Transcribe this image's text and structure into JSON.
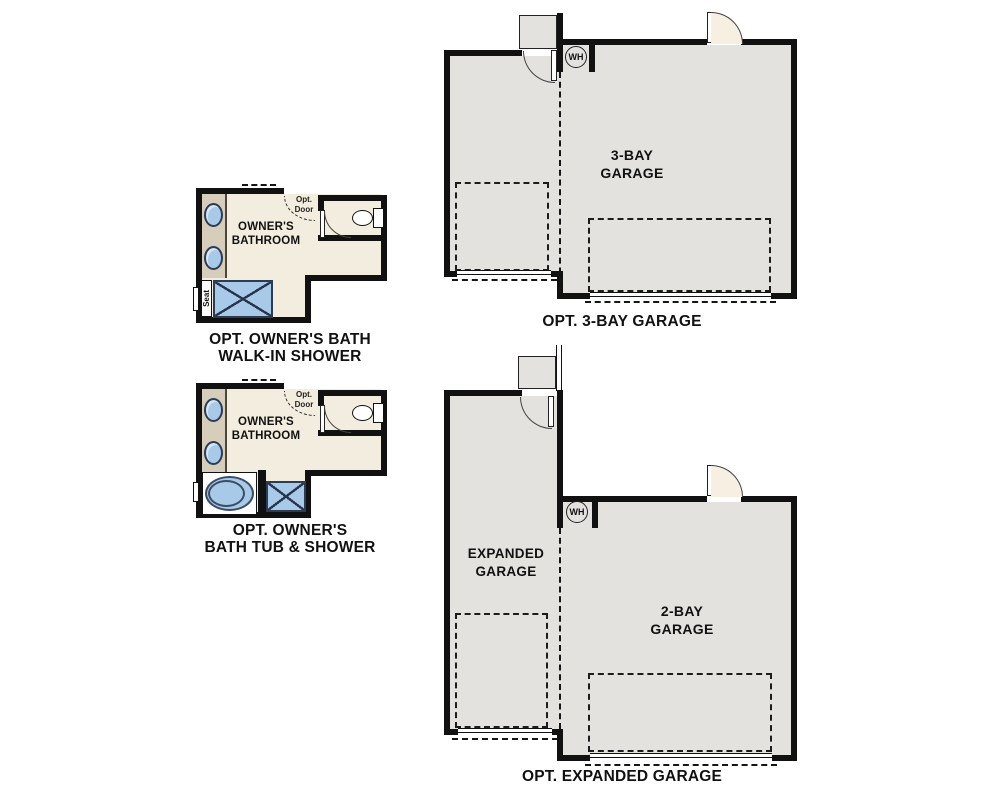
{
  "colors": {
    "wall": "#111111",
    "floor": "#f2edde",
    "garage": "#e3e2df",
    "vanity": "#d6cdbb",
    "fixture": "#a9c9e8",
    "fixture_line": "#2c3c55",
    "swing": "#f6efe2"
  },
  "plans": {
    "bath_walkin": {
      "room_line1": "OWNER'S",
      "room_line2": "BATHROOM",
      "opt_door_line1": "Opt.",
      "opt_door_line2": "Door",
      "seat": "Seat",
      "caption_line1": "OPT. OWNER'S BATH",
      "caption_line2": "WALK-IN SHOWER"
    },
    "bath_tub": {
      "room_line1": "OWNER'S",
      "room_line2": "BATHROOM",
      "opt_door_line1": "Opt.",
      "opt_door_line2": "Door",
      "caption_line1": "OPT. OWNER'S",
      "caption_line2": "BATH TUB & SHOWER"
    },
    "garage_3bay": {
      "label_line1": "3-BAY",
      "label_line2": "GARAGE",
      "wh": "WH",
      "caption": "OPT. 3-BAY GARAGE"
    },
    "garage_expanded": {
      "left_label_line1": "EXPANDED",
      "left_label_line2": "GARAGE",
      "right_label_line1": "2-BAY",
      "right_label_line2": "GARAGE",
      "wh": "WH",
      "caption": "OPT. EXPANDED GARAGE"
    }
  }
}
